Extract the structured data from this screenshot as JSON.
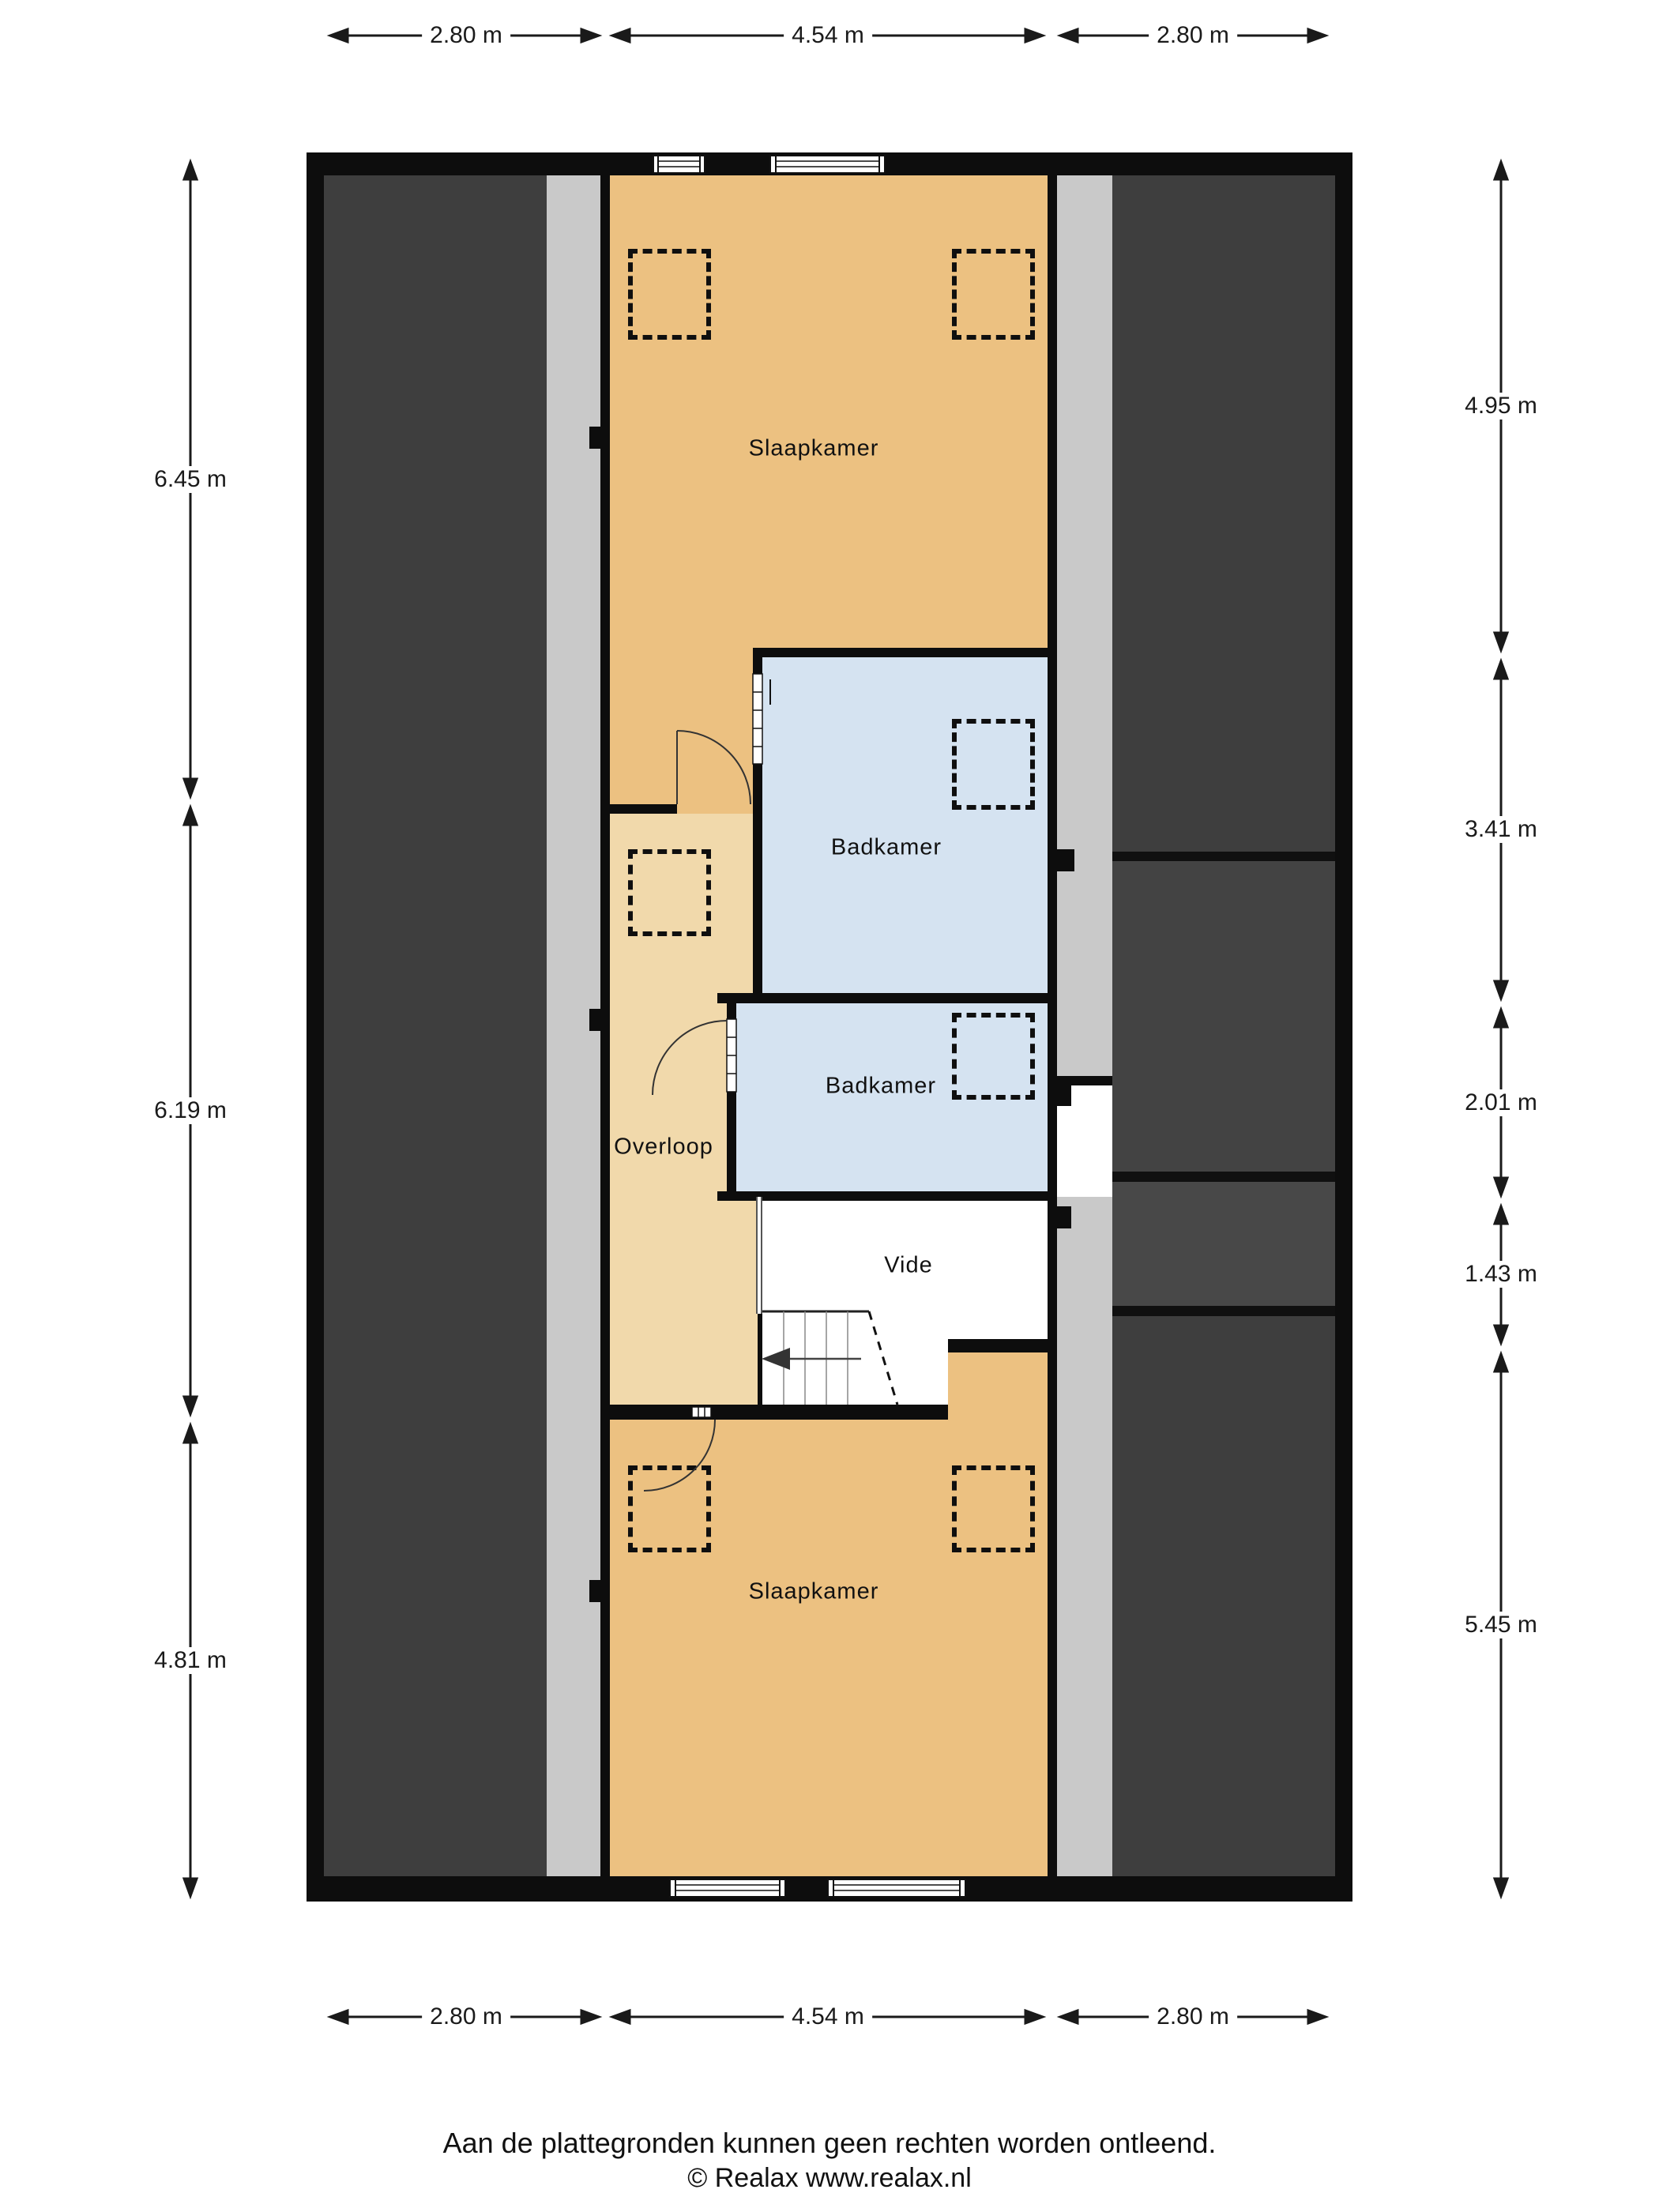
{
  "rooms": {
    "slaapkamer_top": "Slaapkamer",
    "badkamer_1": "Badkamer",
    "badkamer_2": "Badkamer",
    "overloop": "Overloop",
    "vide": "Vide",
    "slaapkamer_bottom": "Slaapkamer"
  },
  "dimensions": {
    "top": [
      "2.80 m",
      "4.54 m",
      "2.80 m"
    ],
    "bottom": [
      "2.80 m",
      "4.54 m",
      "2.80 m"
    ],
    "left": [
      "6.45 m",
      "6.19 m",
      "4.81 m"
    ],
    "right": [
      "4.95 m",
      "3.41 m",
      "2.01 m",
      "1.43 m",
      "5.45 m"
    ]
  },
  "footer": {
    "disclaimer": "Aan de plattegronden kunnen geen rechten worden ontleend.",
    "copyright": "© Realax www.realax.nl"
  },
  "icons": {
    "stairs_direction": "arrow-left"
  },
  "colors": {
    "wall": "#0d0d0d",
    "roof_area": "#3e3e3e",
    "gutter_strip": "#c9c9c9",
    "bedroom": "#ecc181",
    "landing": "#f1d9ab",
    "bathroom": "#d5e3f1",
    "background": "#ffffff"
  }
}
